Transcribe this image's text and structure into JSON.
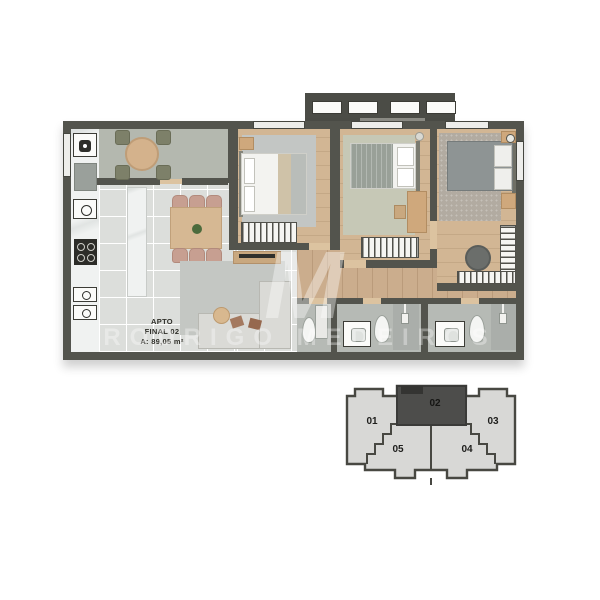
{
  "page": {
    "background": "#ffffff"
  },
  "floorplan": {
    "label": {
      "line1": "APTO",
      "line2": "FINAL 02",
      "line3": "A: 89,05 m²"
    },
    "colors": {
      "wall": "#53544d",
      "tile_floor": "#dcdedb",
      "wood_floor": "#cbad8d",
      "balcony_floor": "#b4b8af",
      "bathroom_floor": "#b6bab5",
      "rug_gray": "#c4c7c3",
      "rug_green": "#c6c8b6",
      "rug_taupe": "#b2aba1",
      "marble": "#f0f2f1"
    }
  },
  "watermark": {
    "monogram": "M",
    "text": "RODRIGO MEDEIROS"
  },
  "keyplan": {
    "highlighted_unit": "02",
    "fill_color": "#d8d8d6",
    "highlight_color": "#4d4d4b",
    "outline_color": "#484842",
    "units": [
      {
        "id": "01",
        "label": "01"
      },
      {
        "id": "02",
        "label": "02"
      },
      {
        "id": "03",
        "label": "03"
      },
      {
        "id": "04",
        "label": "04"
      },
      {
        "id": "05",
        "label": "05"
      }
    ]
  }
}
